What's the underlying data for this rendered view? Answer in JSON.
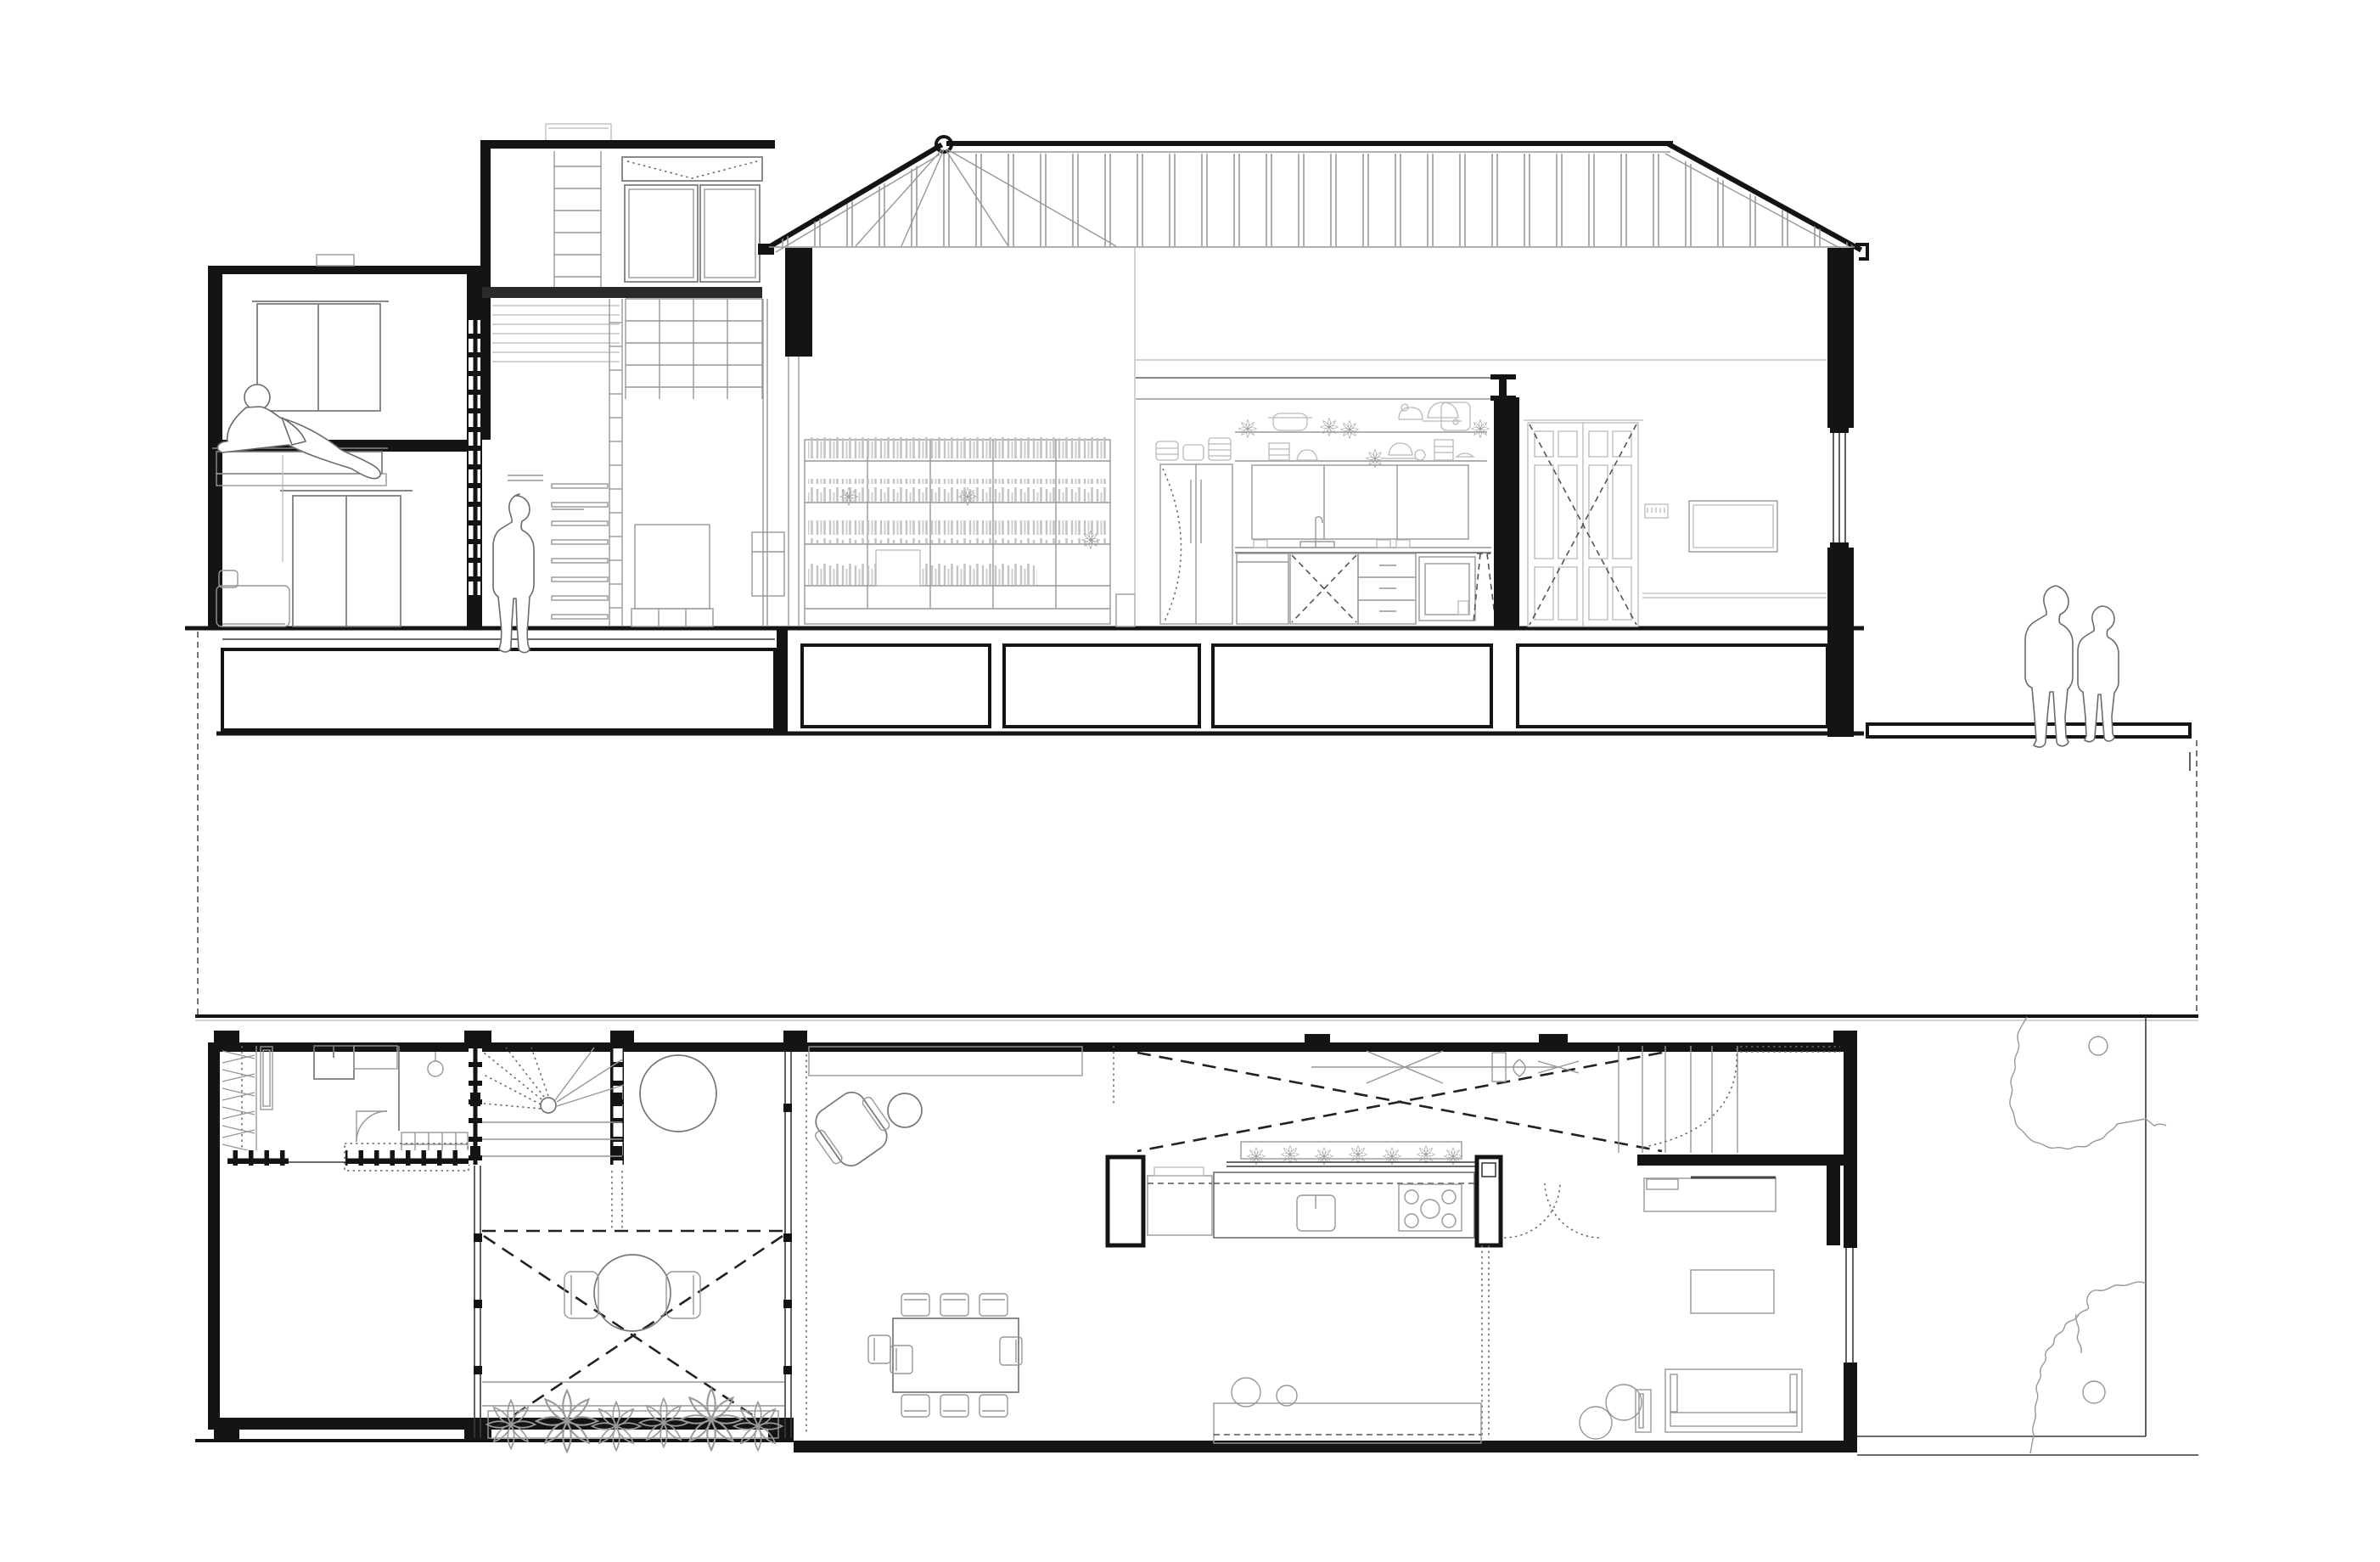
{
  "meta": {
    "title": "Residential architecture drawing — longitudinal cross-section and ground floor plan",
    "description": "Black and white architectural line drawing. Top: cross-section through a long narrow house with a two-storey street block, mezzanine with ladder, hipped timber roof over a double-height living hall with full wall bookshelf, kitchen elevation with open shelves of pots and plants, panelled rear door, and foundation piers below ground line. Bottom: ground floor plan with entry/closet room, winder stair, planted courtyard with round table, living-dining room, kitchen with island counter under an open void, rear bedroom, and a rear garden with two trees. Four human figures: one reclining on a window seat, one standing in the stair hall, and a couple standing in the rear lane.",
    "drawing_types": [
      "cross-section",
      "floor-plan"
    ],
    "scale_text": "",
    "visible_text": []
  },
  "colors": {
    "background": "#ffffff",
    "cut_walls": "#141414",
    "medium_linework": "#777777",
    "light_linework": "#b9b9b9",
    "dashed_projection": "#222222"
  },
  "section": {
    "elements": [
      {
        "label": "street-house",
        "storeys": 2,
        "features": [
          "window seat with reclining figure",
          "double door",
          "sofa",
          "pendant light"
        ]
      },
      {
        "label": "mezzanine-block",
        "features": [
          "roof railing",
          "ladder",
          "transom window with dashed opening arrows",
          "glazed grid balustrade",
          "stair",
          "bed",
          "standing figure"
        ]
      },
      {
        "label": "main-roof",
        "features": [
          "hip apex ring",
          "ridge",
          "stud rafters",
          "eaves gutters both ends"
        ]
      },
      {
        "label": "living-hall",
        "features": [
          "full-height bookshelf with books and plants",
          "side table"
        ]
      },
      {
        "label": "kitchen-elevation",
        "features": [
          "steel I-beam",
          "open shelf with pots, plants, kettles, rice cooker",
          "bowl shelf",
          "upper cabinets",
          "sink and tap",
          "drawer unit",
          "oven",
          "dashed stool",
          "fridge with dashed swing"
        ]
      },
      {
        "label": "rear-hall",
        "features": [
          "panelled double door with dashed X",
          "key rack",
          "wall-hung TV",
          "baseboard",
          "window in cut wall"
        ]
      },
      {
        "label": "ground-works",
        "features": [
          "ground line",
          "five foundation crawl voids",
          "bottom slab",
          "rear sidewalk slab"
        ]
      },
      {
        "label": "figures",
        "people": [
          "couple standing in rear lane"
        ]
      }
    ]
  },
  "plan": {
    "rooms": [
      {
        "label": "entry-room",
        "features": [
          "hanger closet",
          "wardrobe",
          "two appliance boxes",
          "arched door swing",
          "pendant lamp",
          "shoe cubby grid",
          "dashed skylight outline",
          "cubby partition wall"
        ]
      },
      {
        "label": "winder-stair",
        "features": [
          "glass-block flanking walls",
          "newel circle",
          "dashed up-flight",
          "solid treads"
        ]
      },
      {
        "label": "front-terrace",
        "features": [
          "round table"
        ]
      },
      {
        "label": "courtyard",
        "features": [
          "glazed walls both sides",
          "dashed roof edge",
          "large dashed X skylight",
          "round table with two chairs",
          "planter with six flower clusters"
        ]
      },
      {
        "label": "living-dining",
        "features": [
          "planting bed along facade",
          "rotated armchair with ottoman",
          "8-seat dining table"
        ]
      },
      {
        "label": "kitchen",
        "features": [
          "void above with dashed X and hanging pot rack",
          "herb planter window",
          "island counter with sink and 5-burner stove",
          "black service piers",
          "double dashed door swings",
          "window bench with cushions"
        ]
      },
      {
        "label": "rear-room",
        "features": [
          "straight stair",
          "dotted door swing",
          "desk",
          "ottoman",
          "daybed",
          "pouf",
          "leaning picture frame",
          "window in side wall"
        ]
      },
      {
        "label": "garden",
        "features": [
          "boundary fence",
          "two tree canopies with trunk circles"
        ]
      }
    ],
    "people": 0,
    "trees": 2
  },
  "figure_counts": {
    "people_total": 4,
    "reclining": 1,
    "standing_inside": 1,
    "standing_outside": 2
  }
}
